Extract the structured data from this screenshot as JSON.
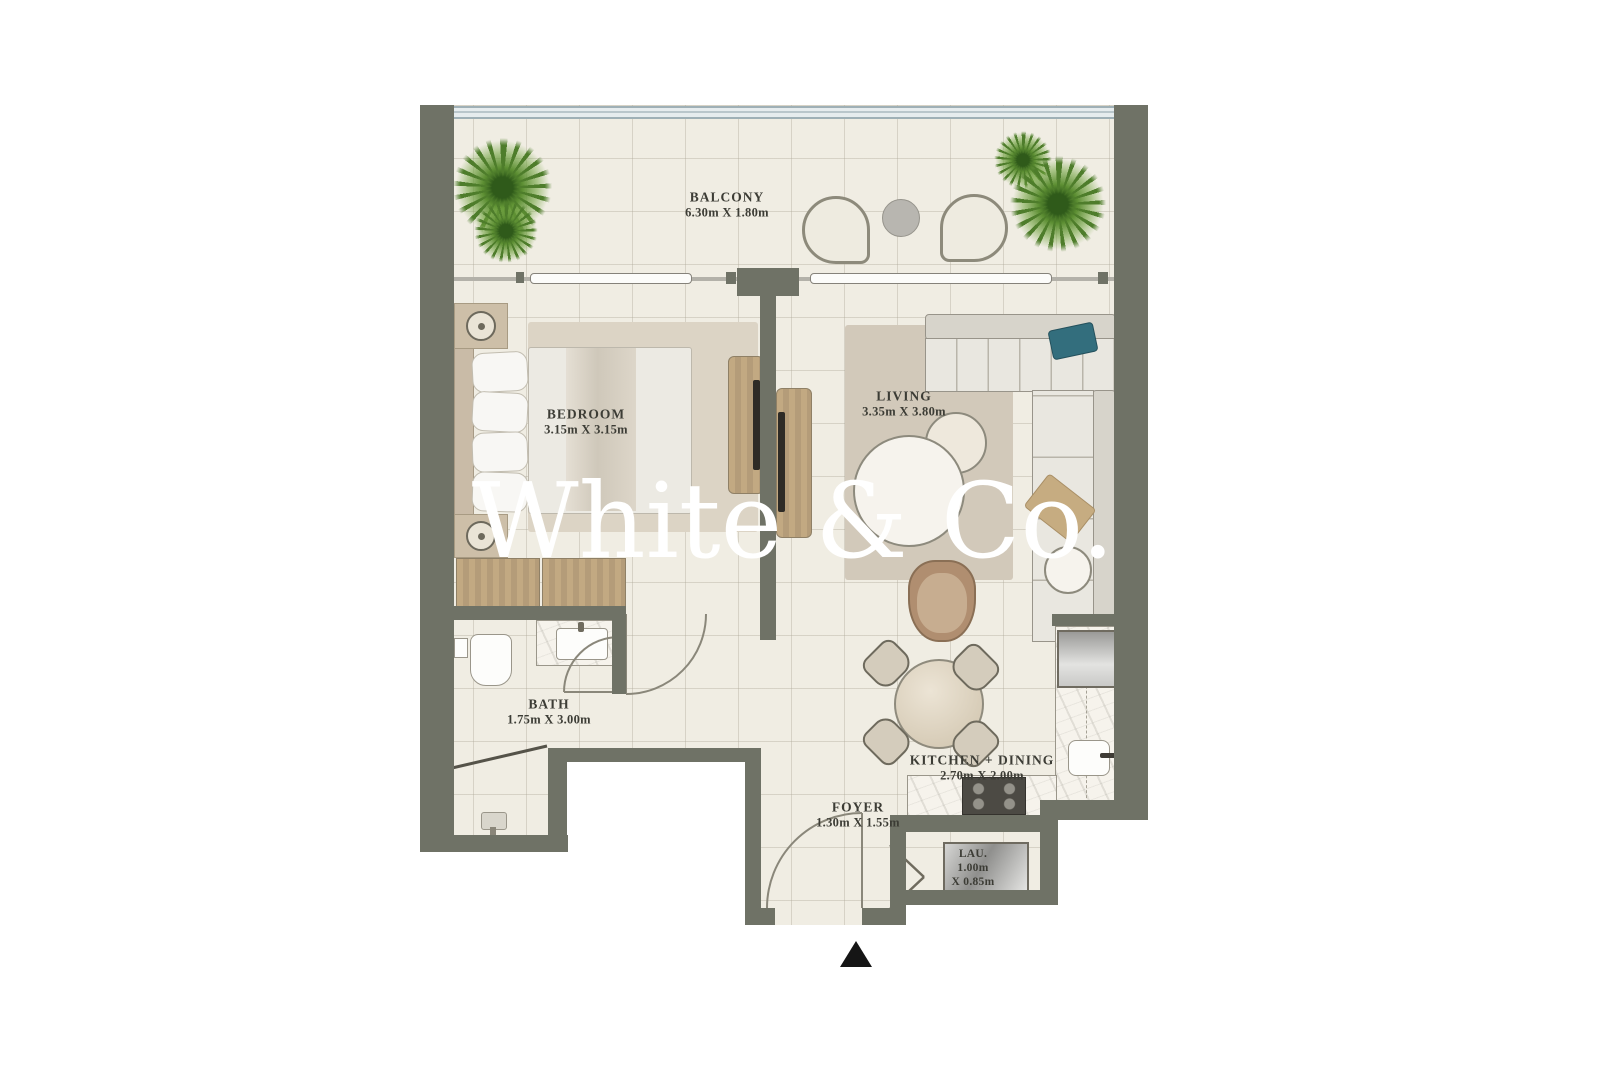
{
  "watermark": {
    "text": "White & Co."
  },
  "rooms": {
    "balcony": {
      "label": "BALCONY",
      "dimensions": "6.30m X 1.80m"
    },
    "bedroom": {
      "label": "BEDROOM",
      "dimensions": "3.15m X 3.15m"
    },
    "living": {
      "label": "LIVING",
      "dimensions": "3.35m X 3.80m"
    },
    "bath": {
      "label": "BATH",
      "dimensions": "1.75m X 3.00m"
    },
    "kitchen_dining": {
      "label": "KITCHEN + DINING",
      "dimensions": "2.70m X 2.00m"
    },
    "foyer": {
      "label": "FOYER",
      "dimensions": "1.30m X 1.55m"
    },
    "laundry": {
      "label": "LAU.",
      "dimensions_line1": "1.00m",
      "dimensions_line2": "X 0.85m"
    }
  },
  "colors": {
    "wall": "#6f7266",
    "floor": "#f0ede3",
    "plant_green": "#5d8f33",
    "accent_teal": "#336e7d",
    "wood": "#bda283",
    "watermark": "#ffffff",
    "entrance_marker": "#151515"
  }
}
